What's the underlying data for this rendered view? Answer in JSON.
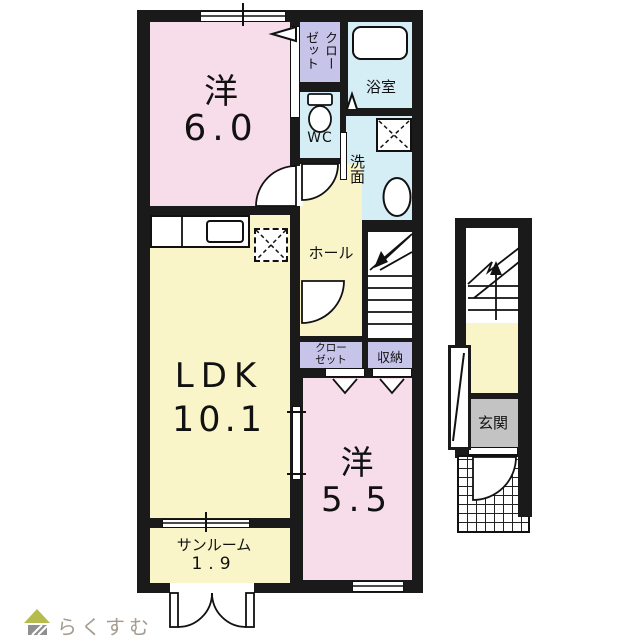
{
  "palette": {
    "wall": "#1a1a1a",
    "room_pink": "#f7dcea",
    "room_yellow": "#faf5c8",
    "room_blue": "#d5eef5",
    "closet_purple": "#c7c4e9",
    "genkan_gray": "#c3c3c3",
    "logo_text_color": "#a69b90",
    "logo_roof_color": "#b6bb4d",
    "logo_body_color": "#8f8f8f"
  },
  "rooms": {
    "west": {
      "name": "洋",
      "size": "6.0"
    },
    "ldk": {
      "name": "LDK",
      "size": "10.1"
    },
    "east": {
      "name": "洋",
      "size": "5.5"
    },
    "sunroom": {
      "name": "サンルーム",
      "size": "1.9"
    },
    "closet_top": {
      "label": "クローゼット"
    },
    "bath": {
      "label": "浴室"
    },
    "wc": {
      "label": "WC"
    },
    "laundry": {
      "label": "洗面"
    },
    "hall": {
      "label": "ホール"
    },
    "closet_mid": {
      "label": "クローゼット"
    },
    "storage": {
      "label": "収納"
    },
    "genkan": {
      "label": "玄関"
    }
  },
  "logo": {
    "text": "らくすむ"
  }
}
